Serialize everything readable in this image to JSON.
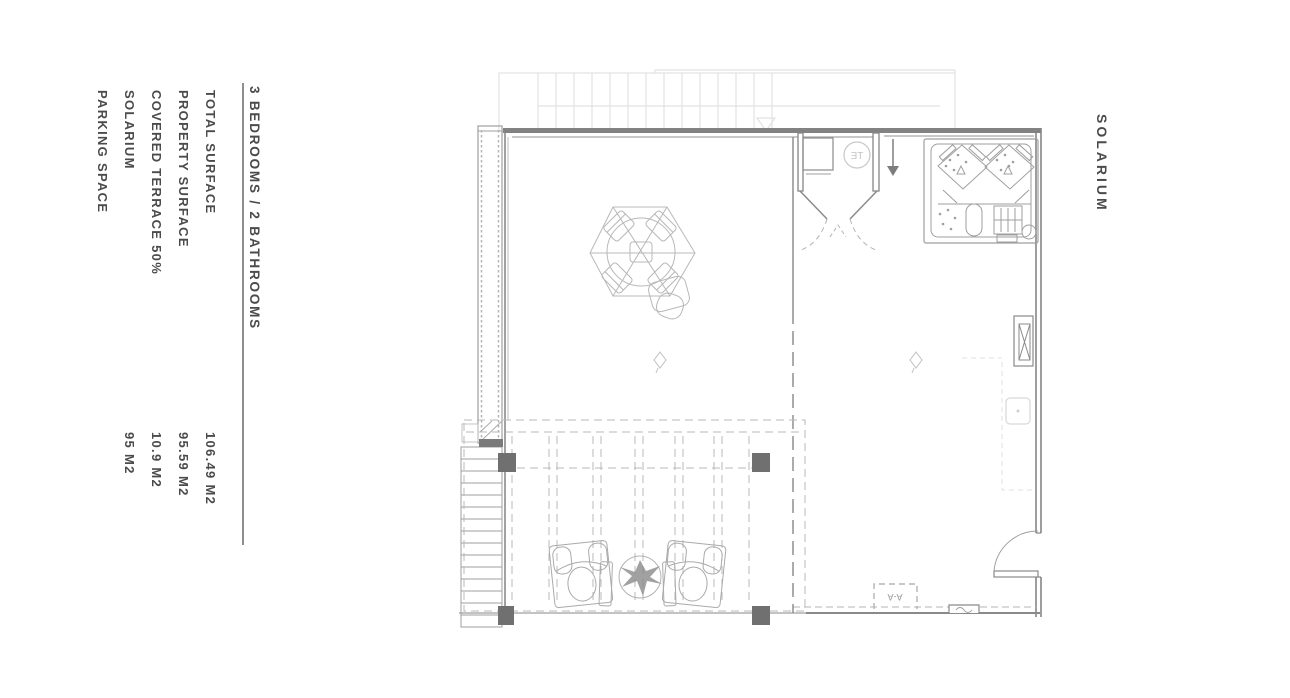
{
  "left_panel": {
    "title": "3 BEDROOMS / 2 BATHROOMS",
    "items": [
      {
        "label": "TOTAL SURFACE",
        "value": "106.49 M2"
      },
      {
        "label": "PROPERTY SURFACE",
        "value": "95.59 M2"
      },
      {
        "label": "COVERED TERRACE 50%",
        "value": "10.9 M2"
      },
      {
        "label": "SOLARIUM",
        "value": "95 M2"
      },
      {
        "label": "PARKING SPACE",
        "value": ""
      }
    ]
  },
  "right_panel": {
    "label": "SOLARIUM"
  },
  "plan": {
    "te_label": "TE",
    "section_label": "A-A"
  },
  "colors": {
    "wall": "#858585",
    "thin_line": "#9f9f9f",
    "dashed_line": "#b4b4b4",
    "faint_line": "#e2e2e2",
    "post": "#707070",
    "text": "#4b4b4b"
  }
}
